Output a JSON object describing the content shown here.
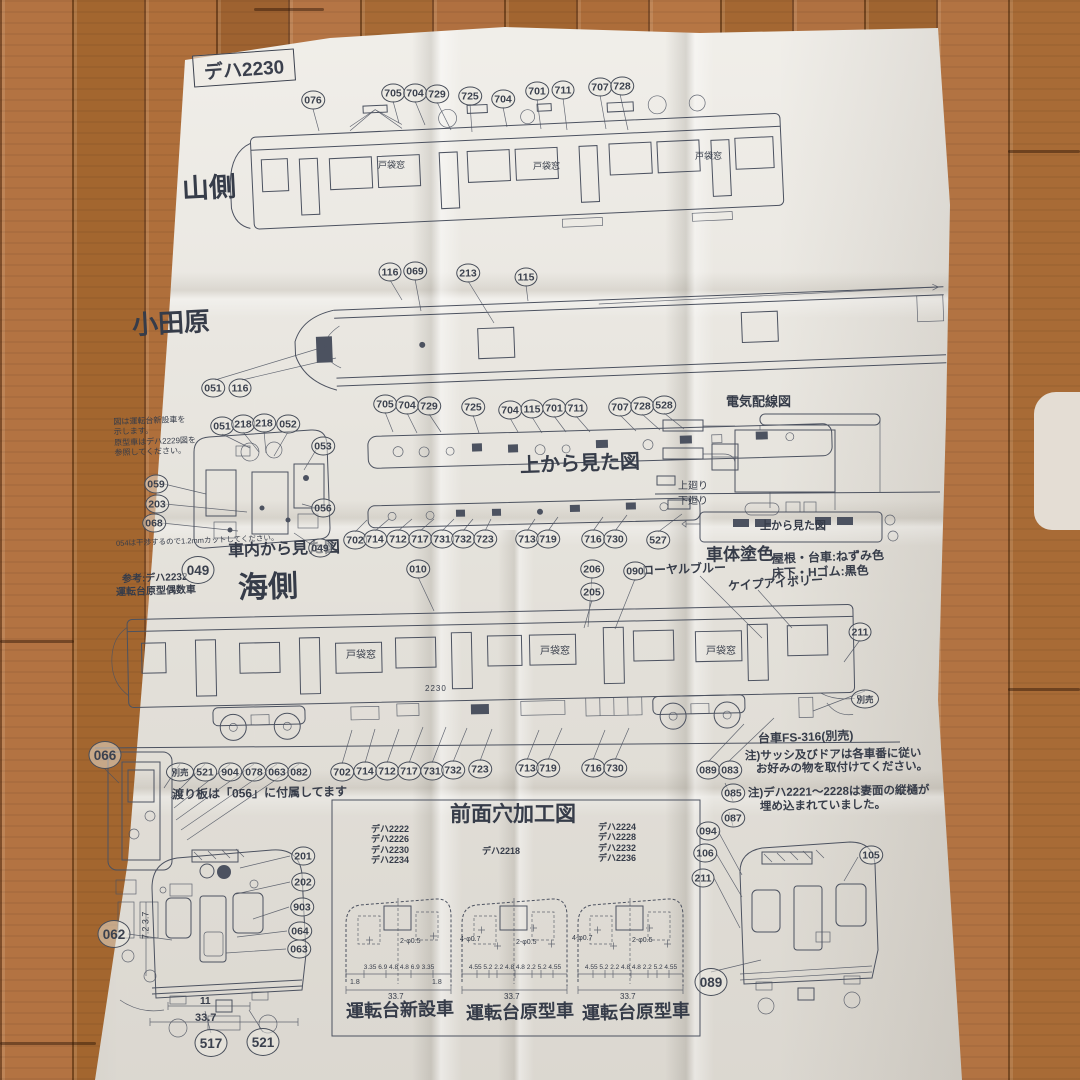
{
  "title": "デハ2230",
  "labels": {
    "mountain_side": "山側",
    "odawara": "小田原",
    "top_view": "上から見た図",
    "cab_view": "車内から見た図",
    "sea_side": "海側",
    "wiring": "電気配線図",
    "wiring_top_view": "上から見た図",
    "upper": "上廻り",
    "lower": "下廻り",
    "body_color_heading": "車体塗色",
    "color_royal_blue": "ローヤルブルー",
    "color_cape_ivory": "ケイプアイボリー",
    "color_roof": "屋根・台車:ねずみ色",
    "color_floor": "床下・Hゴム:黒色",
    "door_pocket": "戸袋窓",
    "ref_line1": "参考:デハ2232",
    "ref_line2": "運転台原型偶数車",
    "front_hole_heading": "前面穴加工図",
    "caption_new_cab": "運転台新設車",
    "caption_orig_cab1": "運転台原型車",
    "caption_orig_cab2": "運転台原型車",
    "bogie": "台車FS-316(別売)",
    "watariita_note": "渡り板は「056」に付属してます",
    "cab_note_l1": "図は運転台新設車を",
    "cab_note_l2": "示します。",
    "cab_note_l3": "原型車はデハ2229図を",
    "cab_note_l4": "参照してください。",
    "cut_note": "054は干渉するので1.2mmカットしてください。",
    "note1_l1": "注)サッシ及びドアは各車番に従い",
    "note1_l2": "お好みの物を取付けてください。",
    "note2_l1": "注)デハ2221〜2228は妻面の縦樋が",
    "note2_l2": "埋め込まれていました。",
    "car_number": "2230"
  },
  "model_lists": {
    "left": [
      "デハ2222",
      "デハ2226",
      "デハ2230",
      "デハ2234"
    ],
    "center": [
      "デハ2218"
    ],
    "right": [
      "デハ2224",
      "デハ2228",
      "デハ2232",
      "デハ2236"
    ]
  },
  "dims": {
    "new_row": "3.35  6.9  4.8  4.8  6.9  3.35",
    "orig_row": "4.55 5.2 2.2 4.8 4.8 2.2 5.2 4.55",
    "one_eight": "1.8",
    "total": "33.7",
    "hole_small": "2-φ0.5",
    "hole_large": "4-φ0.7",
    "front_side": "7.2 3.7",
    "front_inner": "11",
    "front_total": "33.7"
  },
  "pn": {
    "top": [
      "076",
      "705",
      "704",
      "729",
      "725",
      "704",
      "701",
      "711",
      "707",
      "728"
    ],
    "odawara": [
      "116",
      "069",
      "213",
      "115",
      "051",
      "116"
    ],
    "topview": [
      "705",
      "704",
      "729",
      "725",
      "704",
      "115",
      "701",
      "711",
      "707",
      "728",
      "528"
    ],
    "cab": [
      "051",
      "218",
      "218",
      "052",
      "053",
      "059",
      "203",
      "068",
      "056",
      "049"
    ],
    "cab_big": "049",
    "midrow": [
      "702",
      "714",
      "712",
      "717",
      "731",
      "732",
      "723",
      "713",
      "719",
      "716",
      "730",
      "527"
    ],
    "sea": [
      "010",
      "206",
      "205",
      "090",
      "211"
    ],
    "sea_sold": "別売",
    "botrow": [
      "702",
      "714",
      "712",
      "717",
      "731",
      "732",
      "723",
      "713",
      "719",
      "716",
      "730",
      "089",
      "083"
    ],
    "rightcol": [
      "085",
      "087",
      "094",
      "106",
      "211",
      "105",
      "089"
    ],
    "door": [
      "066",
      "別売",
      "521",
      "904",
      "078",
      "063",
      "082"
    ],
    "front": [
      "062",
      "201",
      "202",
      "903",
      "064",
      "063",
      "517",
      "521"
    ]
  }
}
